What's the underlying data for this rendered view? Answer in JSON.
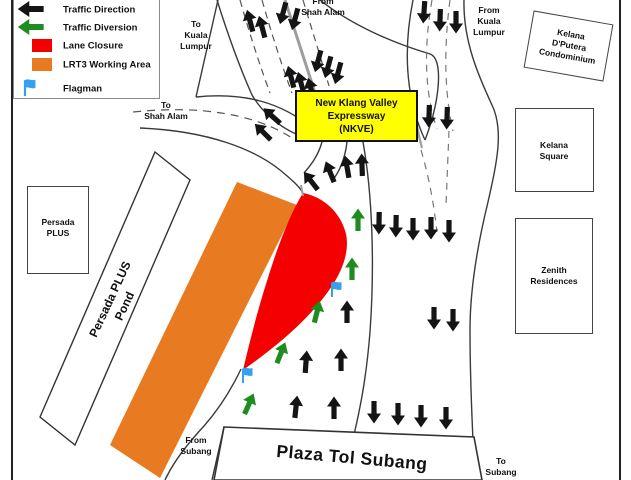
{
  "colors": {
    "traffic_direction": "#141414",
    "traffic_diversion": "#1f8c1f",
    "lane_closure": "#f40000",
    "working_area": "#e87a21",
    "flagman": "#33a0f0",
    "nkve_fill": "#ffff00"
  },
  "legend": {
    "items": [
      {
        "label": "Traffic Direction",
        "type": "arrow-black"
      },
      {
        "label": "Traffic Diversion",
        "type": "arrow-green"
      },
      {
        "label": "Lane Closure",
        "type": "swatch-red"
      },
      {
        "label": "LRT3 Working Area",
        "type": "swatch-orange"
      },
      {
        "label": "Flagman",
        "type": "flag-blue"
      }
    ]
  },
  "road_labels": {
    "to_kuala_lumpur": "To\nKuala\nLumpur",
    "from_shah_alam": "From\nShah Alam",
    "from_kuala_lumpur": "From\nKuala\nLumpur",
    "to_shah_alam": "To\nShah Alam",
    "from_subang": "From\nSubang",
    "to_subang": "To\nSubang"
  },
  "landmarks": {
    "nkve_box": "New Klang Valley\nExpressway\n(NKVE)",
    "persada_plus": "Persada\nPLUS",
    "persada_plus_pond": "Persada PLUS\nPond",
    "kelana_dputera": "Kelana\nD'Putera\nCondominium",
    "kelana_square": "Kelana\nSquare",
    "zenith_residences": "Zenith\nResidences",
    "toll_plaza": "Plaza Tol Subang"
  },
  "map": {
    "arrows": [
      {
        "x": 31,
        "y": 9,
        "rot": -90,
        "color": "black",
        "scale": 1.15,
        "where": "legend"
      },
      {
        "x": 31,
        "y": 27,
        "rot": -90,
        "color": "green",
        "scale": 1.15,
        "where": "legend"
      },
      {
        "x": 250,
        "y": 21,
        "rot": -15,
        "color": "black"
      },
      {
        "x": 262,
        "y": 27,
        "rot": -15,
        "color": "black"
      },
      {
        "x": 283,
        "y": 13,
        "rot": 195,
        "color": "black"
      },
      {
        "x": 295,
        "y": 19,
        "rot": 195,
        "color": "black"
      },
      {
        "x": 291,
        "y": 77,
        "rot": -15,
        "color": "black"
      },
      {
        "x": 301,
        "y": 83,
        "rot": -15,
        "color": "black"
      },
      {
        "x": 311,
        "y": 89,
        "rot": -15,
        "color": "black"
      },
      {
        "x": 318,
        "y": 61,
        "rot": 195,
        "color": "black"
      },
      {
        "x": 328,
        "y": 67,
        "rot": 195,
        "color": "black"
      },
      {
        "x": 338,
        "y": 73,
        "rot": 195,
        "color": "black"
      },
      {
        "x": 272,
        "y": 116,
        "rot": -48,
        "color": "black"
      },
      {
        "x": 263,
        "y": 132,
        "rot": -45,
        "color": "black"
      },
      {
        "x": 311,
        "y": 181,
        "rot": -38,
        "color": "black"
      },
      {
        "x": 330,
        "y": 172,
        "rot": -22,
        "color": "black"
      },
      {
        "x": 347,
        "y": 167,
        "rot": -10,
        "color": "black"
      },
      {
        "x": 362,
        "y": 165,
        "rot": -2,
        "color": "black"
      },
      {
        "x": 424,
        "y": 12,
        "rot": 184,
        "color": "black"
      },
      {
        "x": 440,
        "y": 20,
        "rot": 182,
        "color": "black"
      },
      {
        "x": 456,
        "y": 22,
        "rot": 180,
        "color": "black"
      },
      {
        "x": 429,
        "y": 116,
        "rot": 182,
        "color": "black"
      },
      {
        "x": 447,
        "y": 118,
        "rot": 182,
        "color": "black"
      },
      {
        "x": 379,
        "y": 223,
        "rot": 181,
        "color": "black"
      },
      {
        "x": 396,
        "y": 226,
        "rot": 181,
        "color": "black"
      },
      {
        "x": 413,
        "y": 229,
        "rot": 180,
        "color": "black"
      },
      {
        "x": 431,
        "y": 228,
        "rot": 180,
        "color": "black"
      },
      {
        "x": 449,
        "y": 231,
        "rot": 180,
        "color": "black"
      },
      {
        "x": 434,
        "y": 318,
        "rot": 180,
        "color": "black"
      },
      {
        "x": 453,
        "y": 320,
        "rot": 180,
        "color": "black"
      },
      {
        "x": 374,
        "y": 412,
        "rot": 180,
        "color": "black"
      },
      {
        "x": 398,
        "y": 414,
        "rot": 180,
        "color": "black"
      },
      {
        "x": 421,
        "y": 416,
        "rot": 180,
        "color": "black"
      },
      {
        "x": 446,
        "y": 418,
        "rot": 180,
        "color": "black"
      },
      {
        "x": 347,
        "y": 312,
        "rot": 0,
        "color": "black"
      },
      {
        "x": 306,
        "y": 362,
        "rot": 4,
        "color": "black"
      },
      {
        "x": 341,
        "y": 360,
        "rot": 0,
        "color": "black"
      },
      {
        "x": 296,
        "y": 407,
        "rot": 6,
        "color": "black"
      },
      {
        "x": 334,
        "y": 408,
        "rot": 0,
        "color": "black"
      },
      {
        "x": 358,
        "y": 220,
        "rot": 0,
        "color": "green"
      },
      {
        "x": 352,
        "y": 269,
        "rot": 0,
        "color": "green"
      },
      {
        "x": 317,
        "y": 312,
        "rot": 14,
        "color": "green"
      },
      {
        "x": 281,
        "y": 353,
        "rot": 22,
        "color": "green"
      },
      {
        "x": 249,
        "y": 404,
        "rot": 24,
        "color": "green"
      }
    ],
    "flags": [
      {
        "x": 25,
        "y": 95,
        "scale": 1.1,
        "where": "legend"
      },
      {
        "x": 332,
        "y": 296
      },
      {
        "x": 243,
        "y": 382
      }
    ]
  }
}
